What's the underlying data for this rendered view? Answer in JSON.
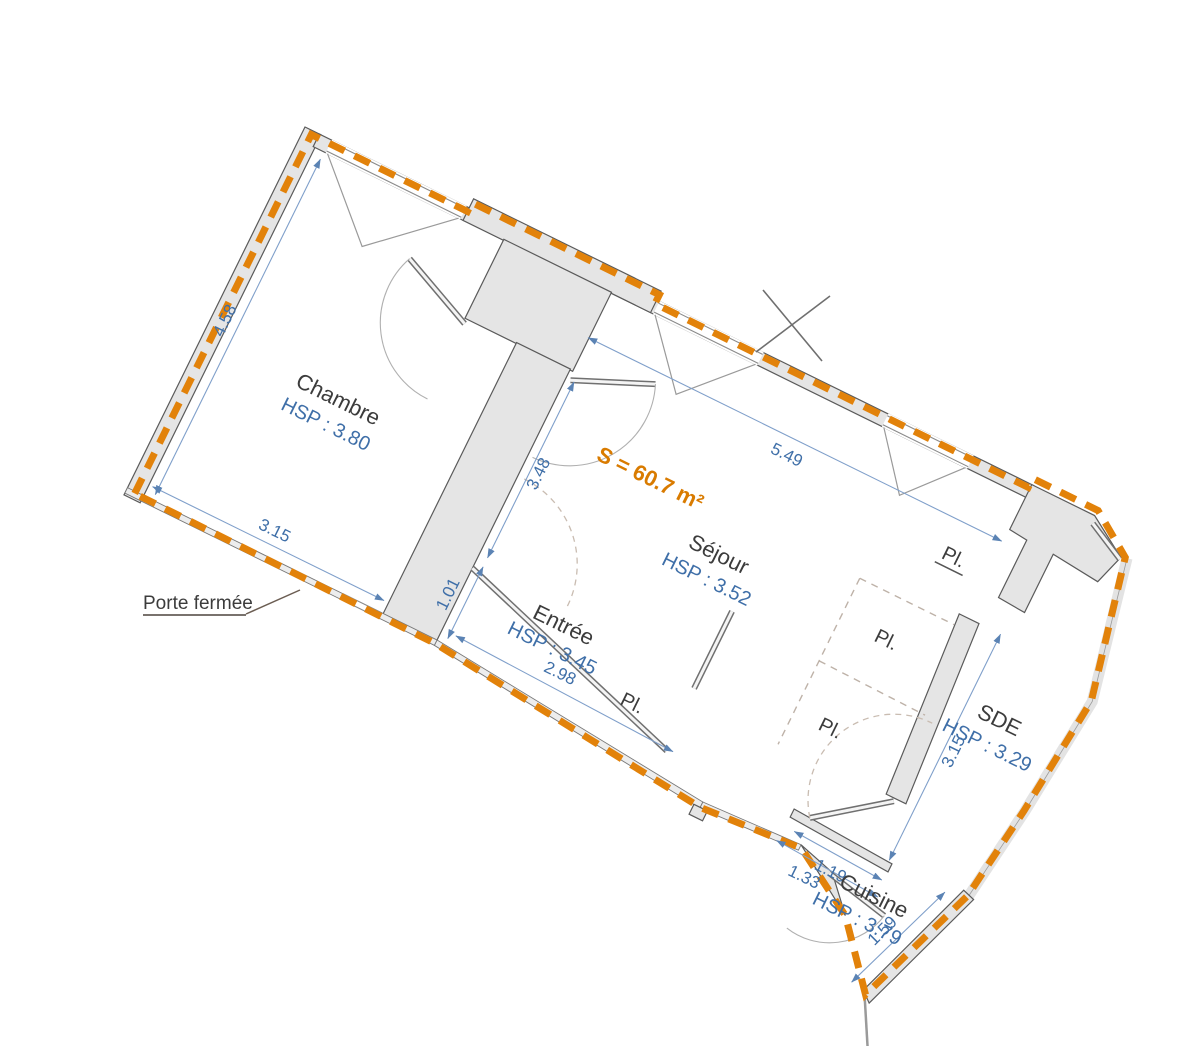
{
  "plan": {
    "area_label": "S = 60.7 m²",
    "rooms": [
      {
        "name": "Chambre",
        "hsp": "HSP : 3.80"
      },
      {
        "name": "Séjour",
        "hsp": "HSP : 3.52"
      },
      {
        "name": "Entrée",
        "hsp": "HSP : 3.45"
      },
      {
        "name": "SDE",
        "hsp": "HSP : 3.29"
      },
      {
        "name": "Cuisine",
        "hsp": "HSP : 3.79"
      }
    ],
    "closet_label": "Pl.",
    "door_note": "Porte fermée",
    "dims": {
      "chambre_side": "4.58",
      "chambre_bottom": "3.15",
      "sejour_left": "3.48",
      "sejour_top": "5.49",
      "entree_left": "1.01",
      "entree_bottom": "2.98",
      "sde_side": "3.15",
      "cuisine_top_inner": "1.19",
      "cuisine_top_outer": "1.33",
      "cuisine_right": "1.59"
    },
    "colors": {
      "boundary": "#E2820A",
      "dimension_text": "#3F6FA8",
      "area_text": "#D97B00",
      "wall_fill": "#E5E5E5",
      "wall_stroke": "#5A5A5A"
    }
  }
}
